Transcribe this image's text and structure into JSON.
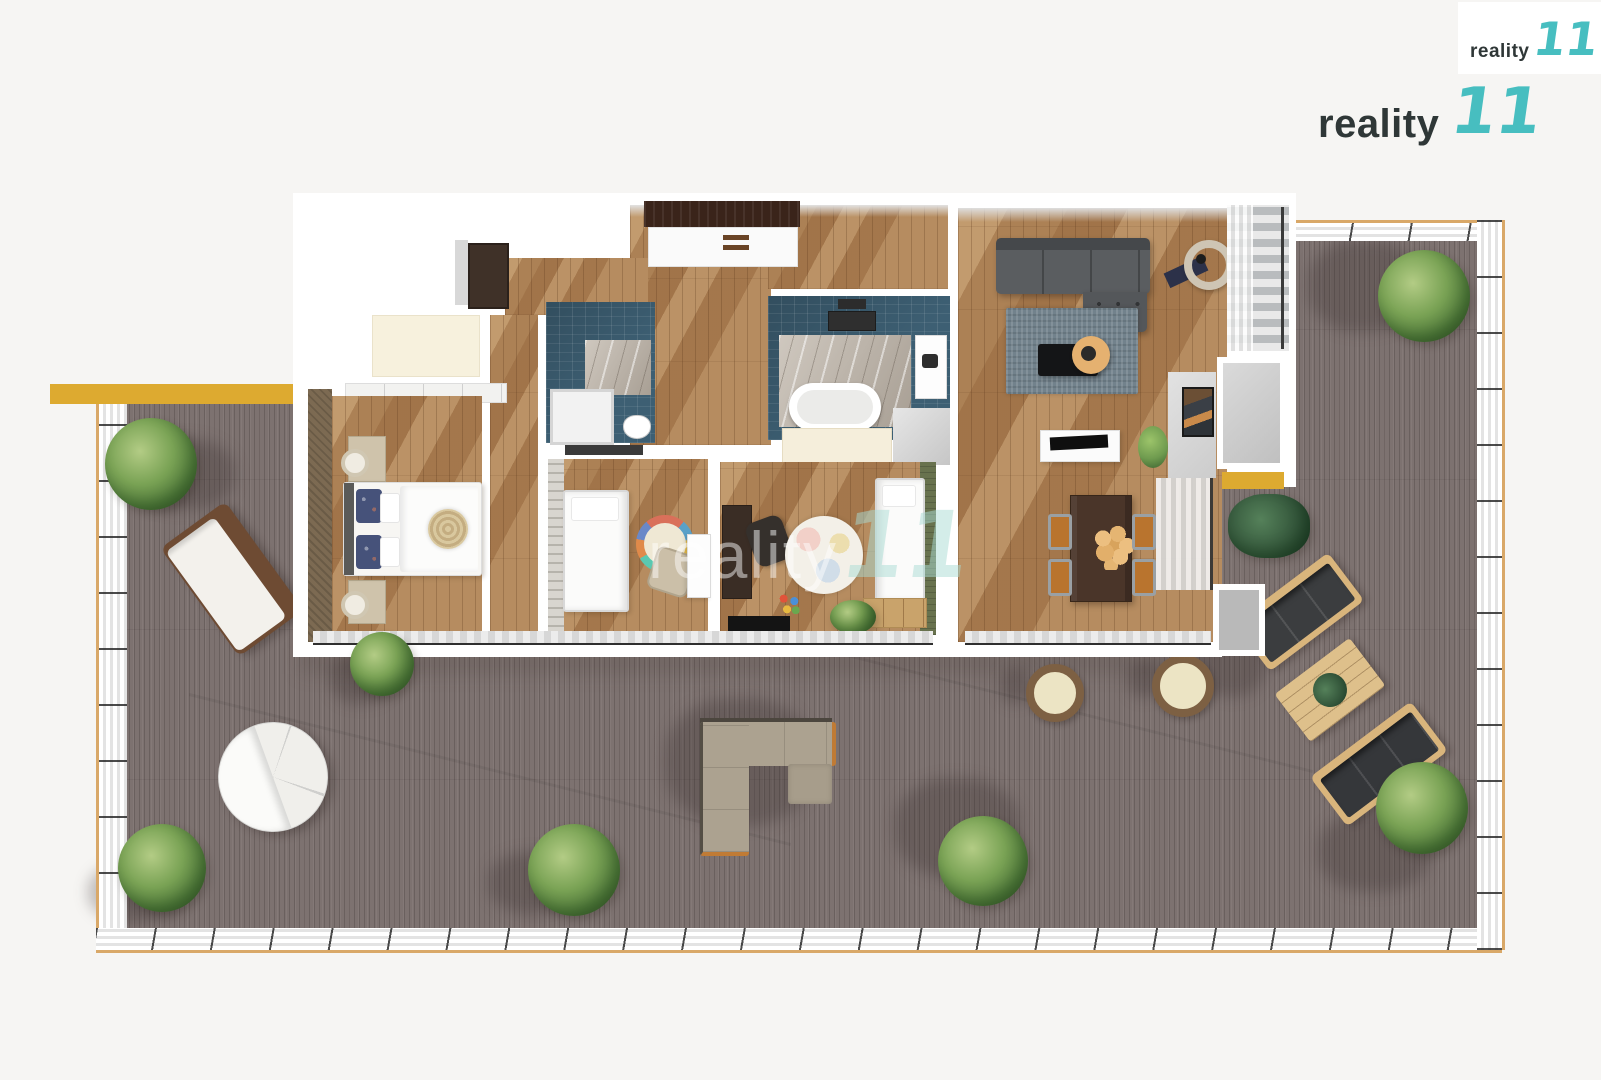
{
  "scene": {
    "type": "floor-plan-3d-top-down",
    "description": "3D rendered top view of an apartment with wrap-around wooden terrace",
    "background": "#f6f5f3"
  },
  "branding": {
    "logo_small": {
      "text": "reality",
      "mark": "11"
    },
    "logo_large": {
      "text": "reality",
      "mark": "11"
    },
    "watermark": {
      "text": "reality",
      "mark": "11"
    },
    "colors": {
      "mark_teal": "#47bec0",
      "mark_teal_dark": "#2d9a9c",
      "logo_text": "#2f3737"
    }
  },
  "palette": {
    "terrace_deck": "#7d7270",
    "interior_wood": "#a87c50",
    "bathroom_tile": "#3d5f73",
    "accent_yellow": "#ddaa30",
    "railing_trim": "#d9a868",
    "living_sofa_gray": "#5a5d60",
    "dining_chair_orange": "#b9742e",
    "accent_green_wall": "#68724e"
  }
}
